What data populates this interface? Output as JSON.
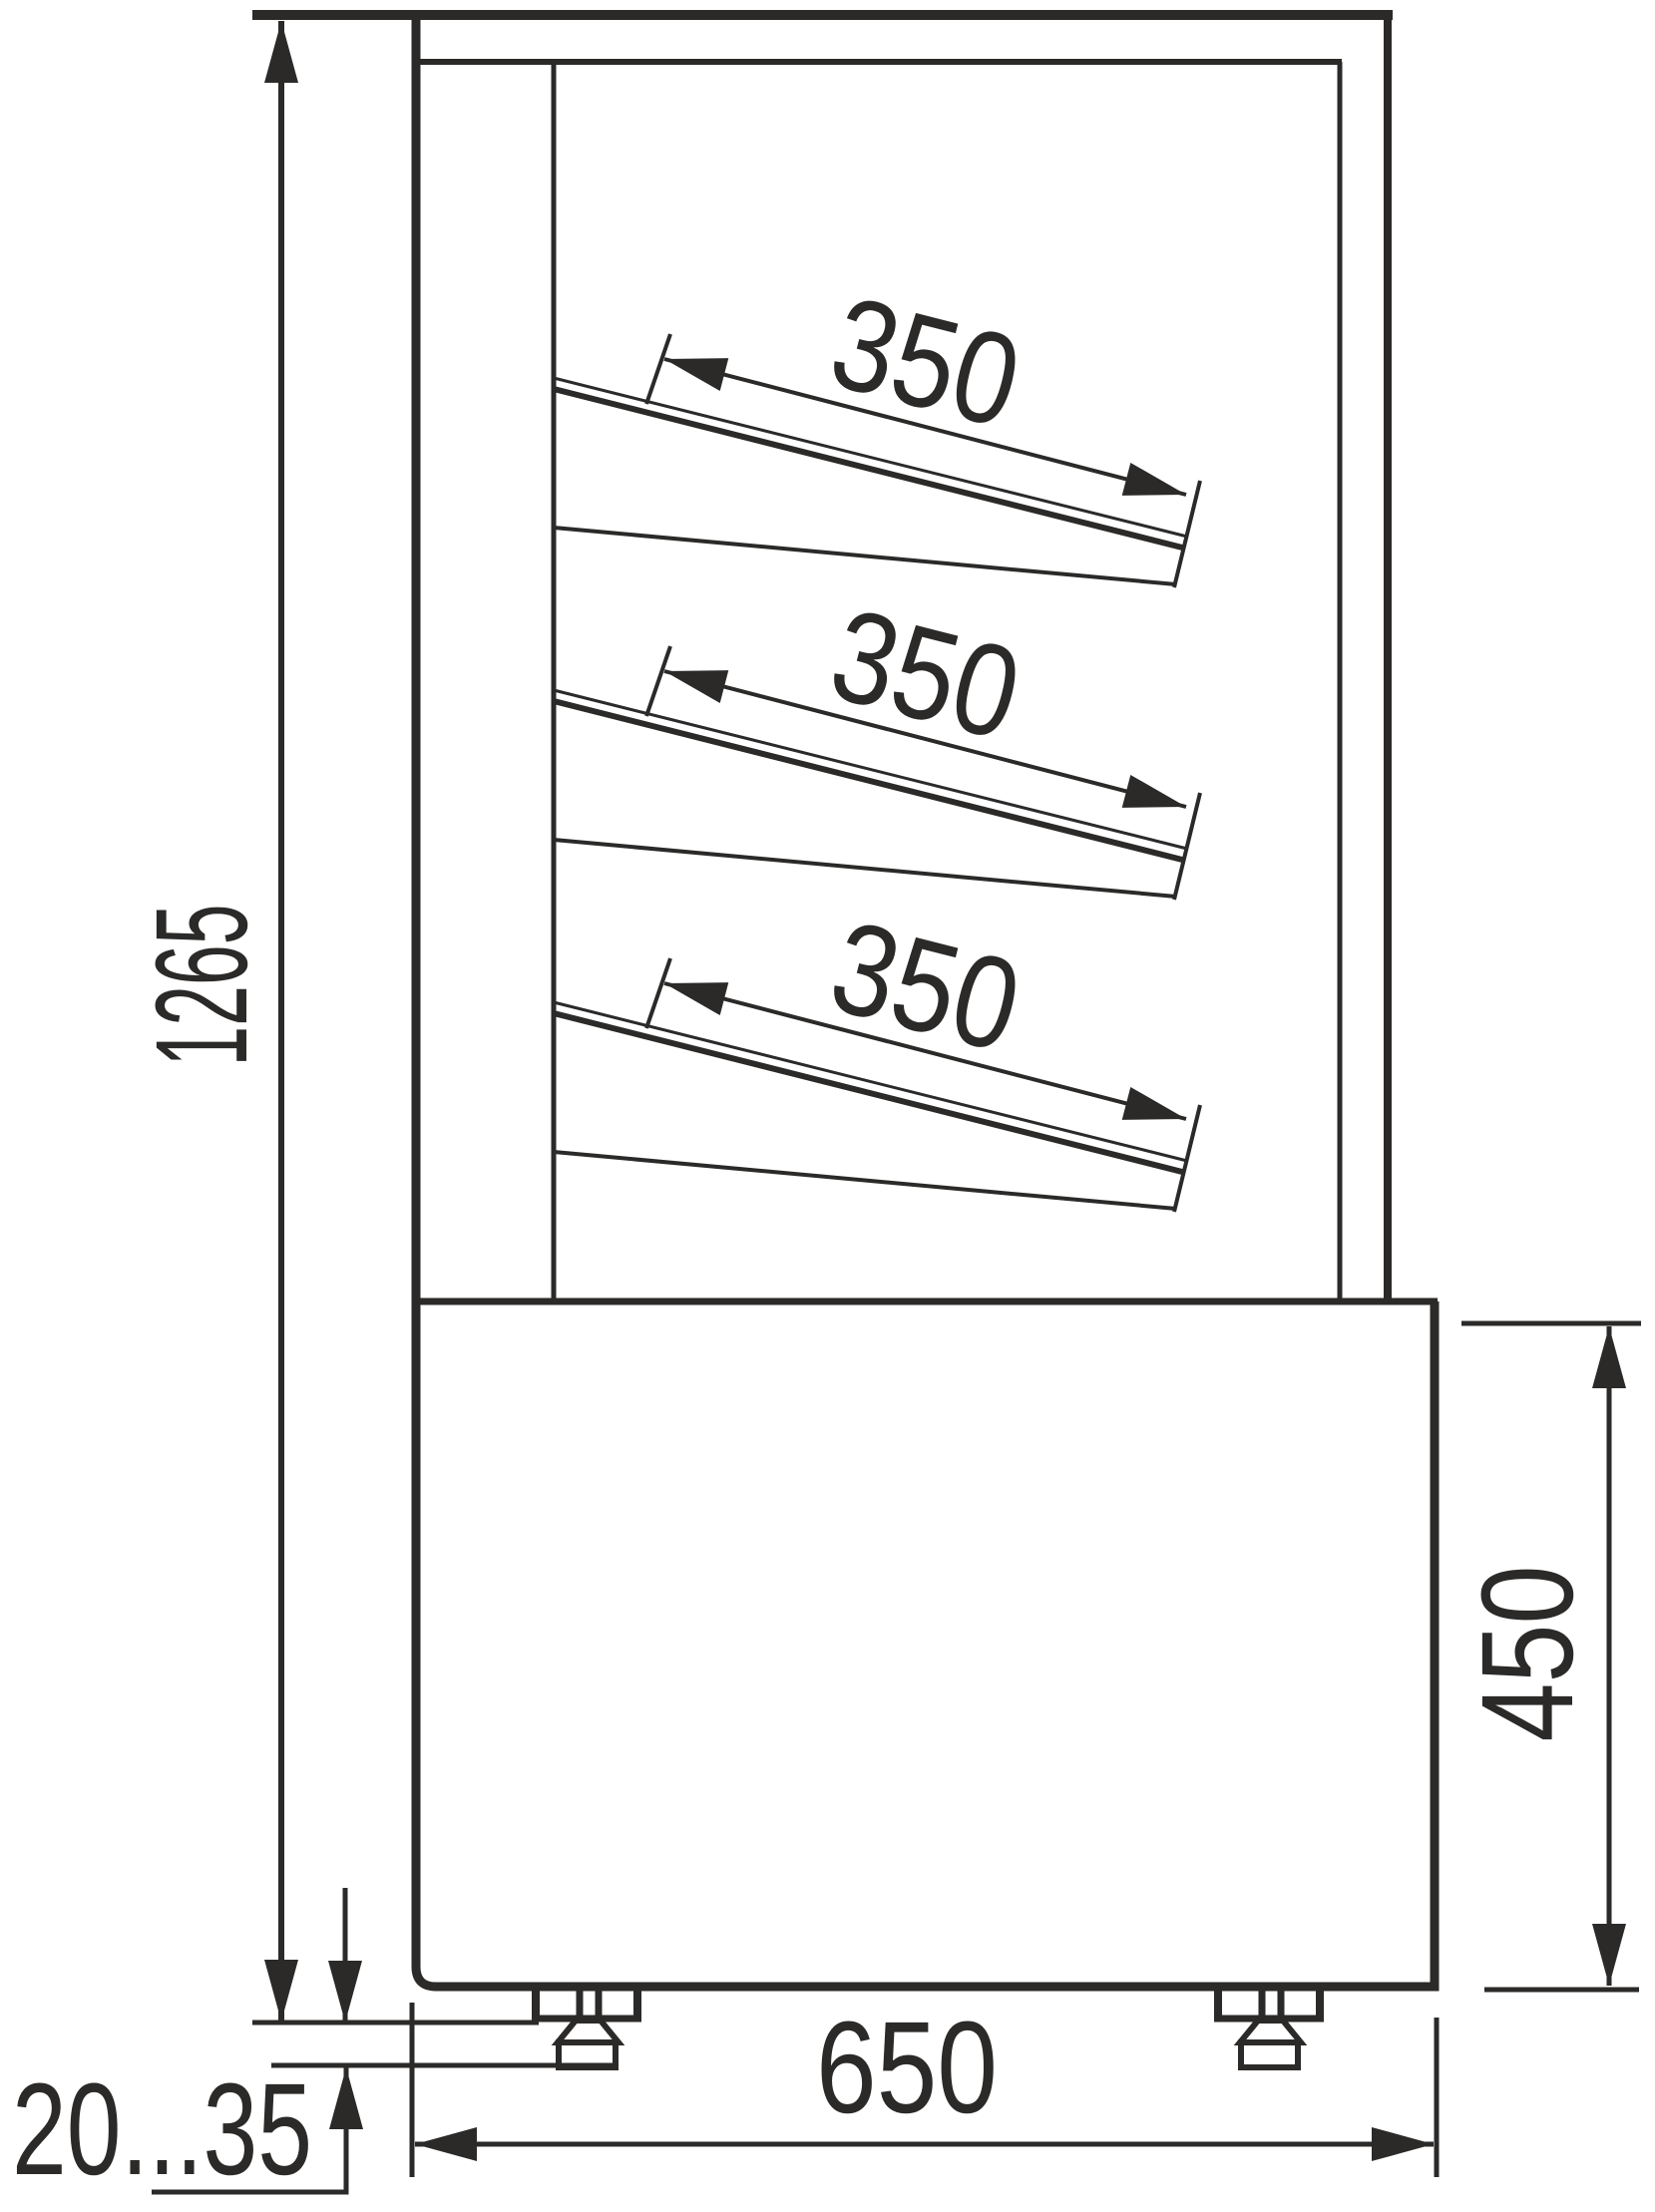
{
  "diagram": {
    "type": "technical-drawing",
    "subject": "Refrigerated display case side view with overall dimensions",
    "line_color": "#2b2a29",
    "background_color": "#ffffff",
    "dimensions": {
      "overall_height": "1265",
      "shelf_1_depth": "350",
      "shelf_2_depth": "350",
      "shelf_3_depth": "350",
      "base_height": "450",
      "base_depth": "650",
      "foot_adjust_range": "20...35"
    }
  }
}
